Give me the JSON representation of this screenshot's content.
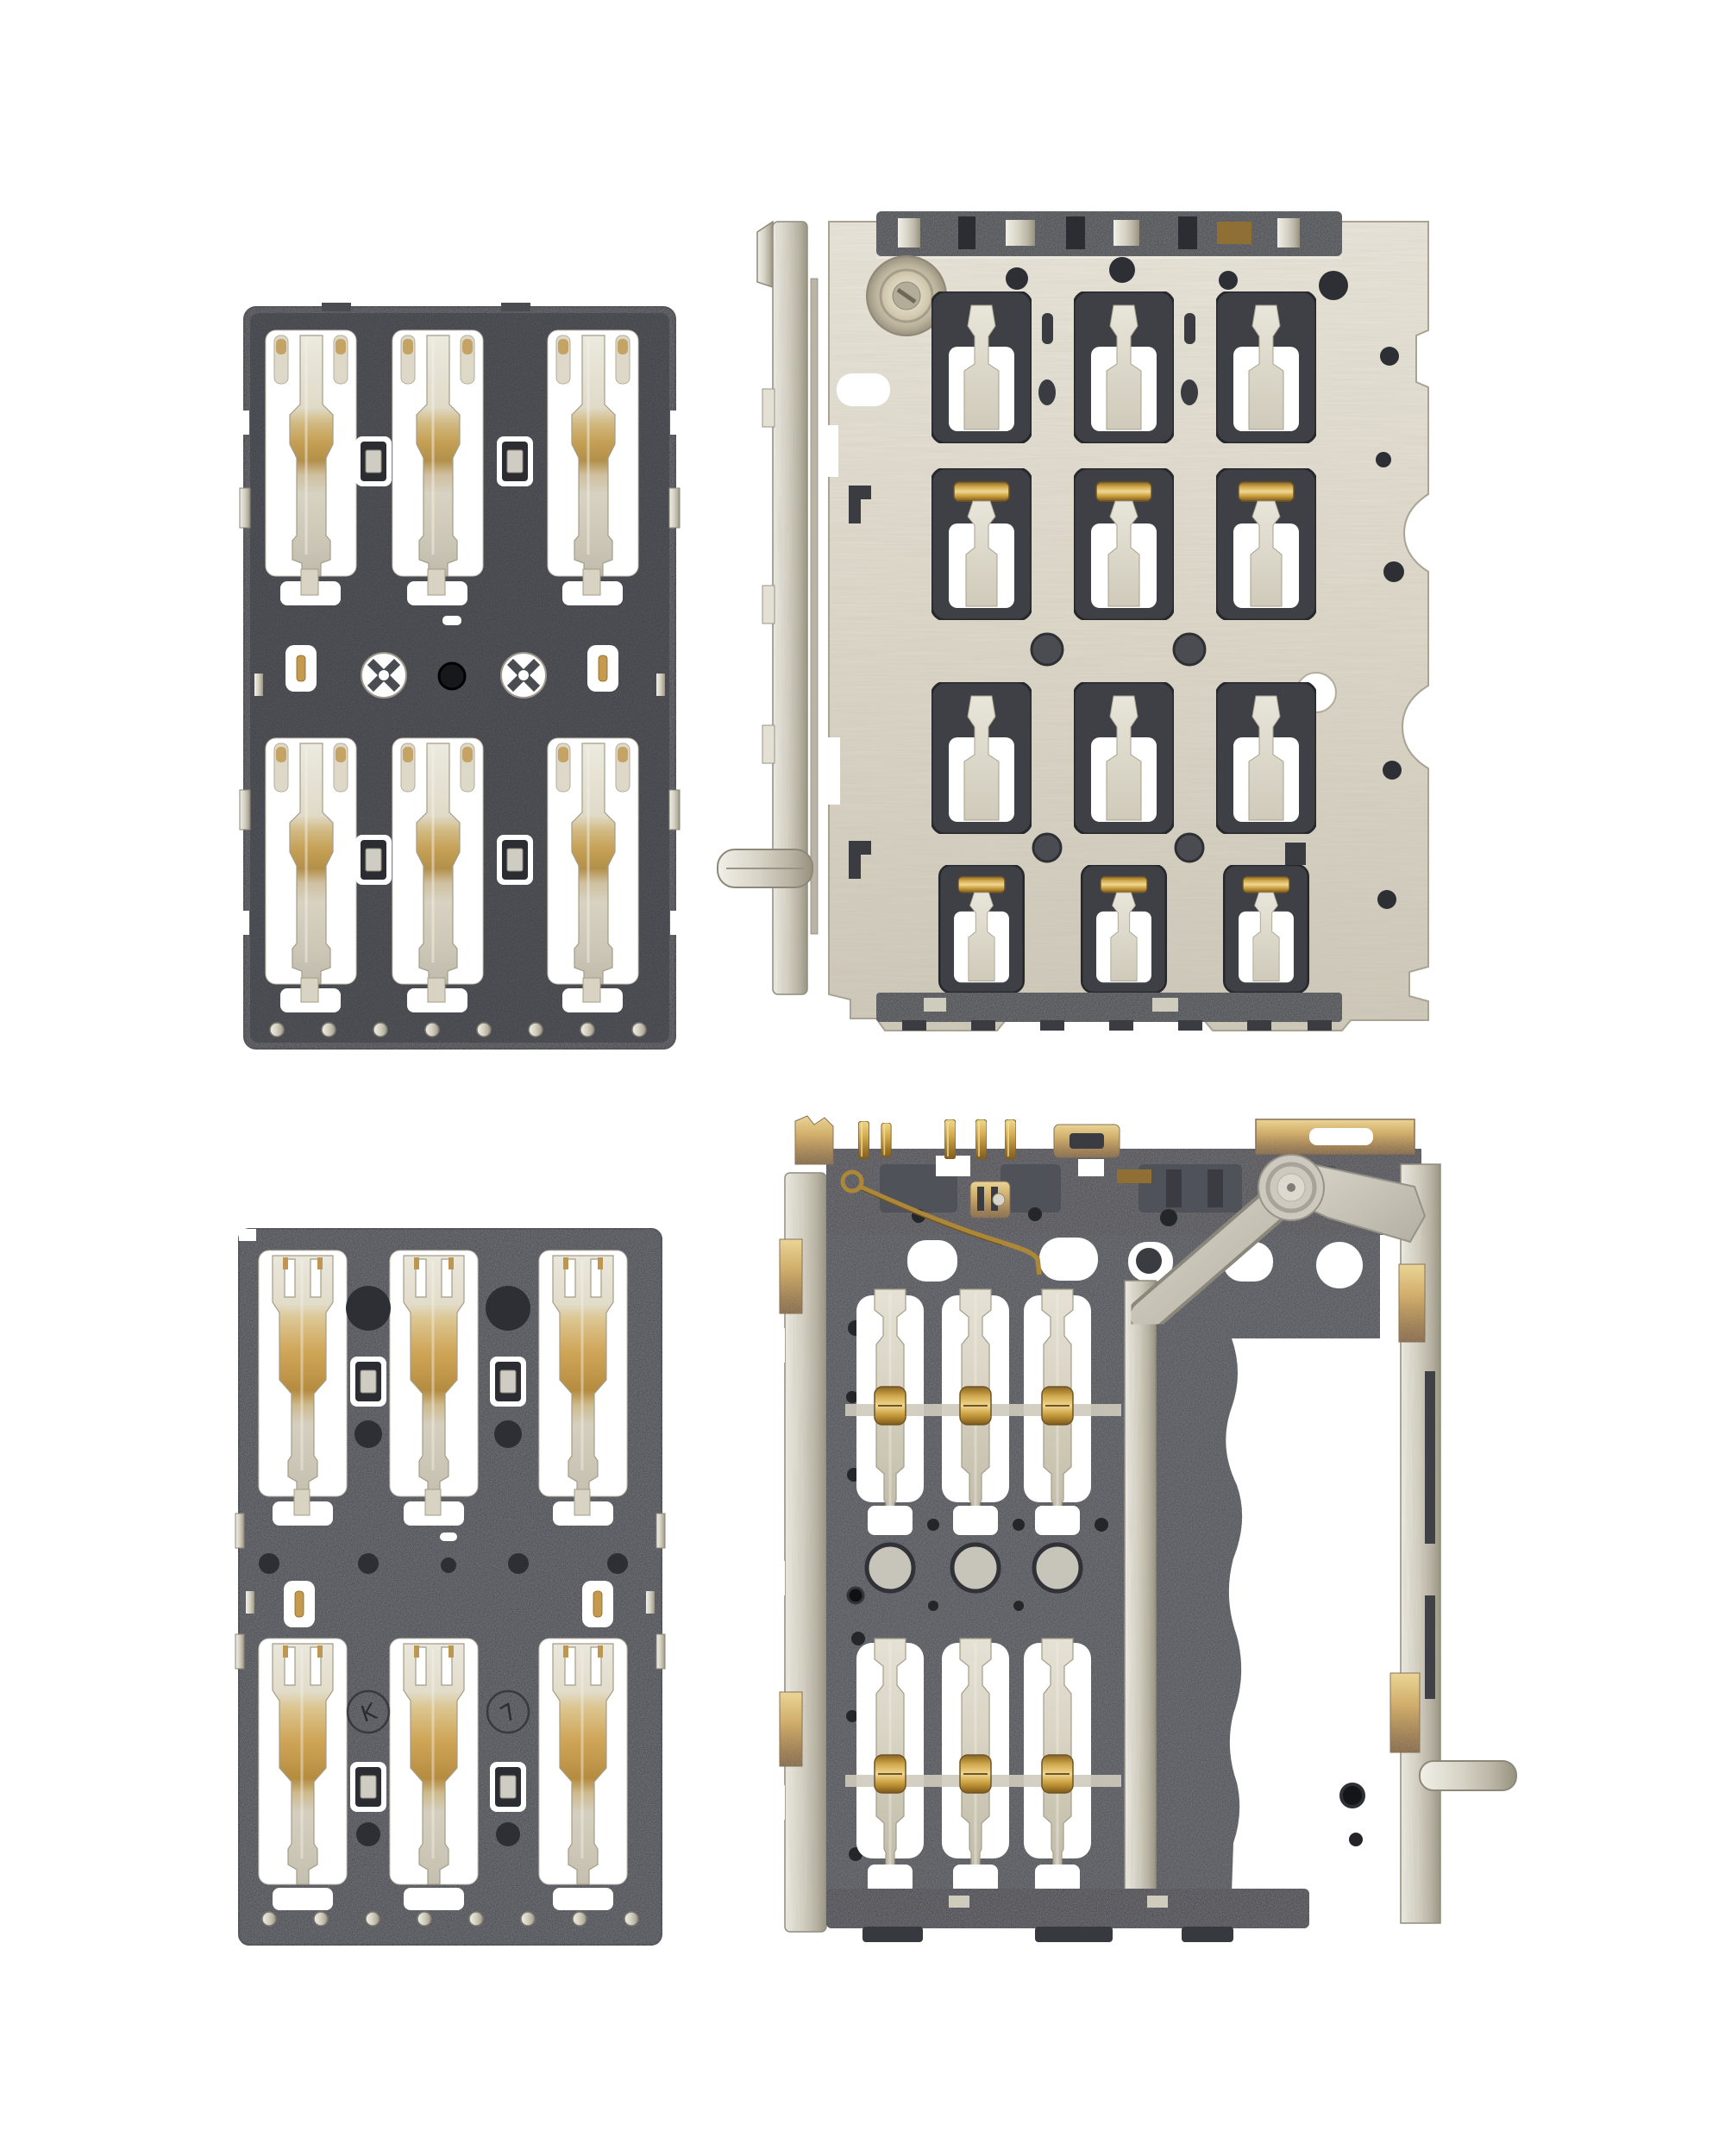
{
  "meta": {
    "type": "product-photo",
    "subject": "Four mobile phone SIM card reader connector components on a white background",
    "background_color": "#ffffff",
    "component_count": 4,
    "arrangement": "2x2 grid"
  },
  "components": {
    "connector_a": {
      "name": "SIM contact connector (small)",
      "position": "top-left",
      "description": "Black plastic board-to-SIM contact block with 6 spring contacts in 2 rows of 3, cross-shaped alignment holes in the middle band and a row of solder dots at the bottom",
      "contact_count": 6,
      "rows": 2,
      "cols": 3,
      "body_color": "#34363c",
      "contact_color": "#d9d2bc",
      "gold_color": "#c0964a"
    },
    "reader_shielded": {
      "name": "SIM card reader with brushed steel shield",
      "position": "top-right",
      "description": "Large brushed stainless shield plate with corner screw rivet, 12 contact windows in a 4x3 grid, scattered round holes, dark plastic visible through cutouts and a side eject rail with foot",
      "window_rows": 4,
      "window_cols": 3,
      "plate_color": "#ded9cb",
      "window_color": "#3e4046",
      "screw": "top-left rivet"
    },
    "connector_b": {
      "name": "SIM contact connector (gold pads)",
      "position": "bottom-left",
      "description": "Black plastic contact block with 6 fork-top spring contacts with broad gold mid sections, molded circular recesses, engraved inspection marks and bottom solder dots",
      "contact_count": 6,
      "rows": 2,
      "cols": 3,
      "body_color": "#3b3d44",
      "gold_color": "#c0964a",
      "engravings": [
        {
          "label": "K"
        },
        {
          "label": "7"
        }
      ]
    },
    "reader_open": {
      "name": "SIM card reader (open frame with eject lever)",
      "position": "bottom-right",
      "description": "Open-frame reader: dark plastic base with 6 spring contacts carrying gold roller bumps, gold solder pins along the top edge, gold edge pads, brushed metal side rails, a gold detect spring wire and a riveted metal eject lever at the top right",
      "contact_count": 6,
      "gold_pin_count": 8,
      "body_color": "#43454b",
      "rail_color": "#d6d2c4",
      "gold_color": "#d2a94e",
      "lever": "riveted pivot, arm sweeping down-left"
    }
  },
  "palette": {
    "background": "#ffffff",
    "plastic_dark": "#34363c",
    "plastic_mid": "#43454b",
    "metal_silver": "#d6d2c4",
    "metal_bright": "#efede6",
    "gold": "#c79a3a",
    "gold_light": "#e8cd7f",
    "bronze": "#9a7b43"
  }
}
